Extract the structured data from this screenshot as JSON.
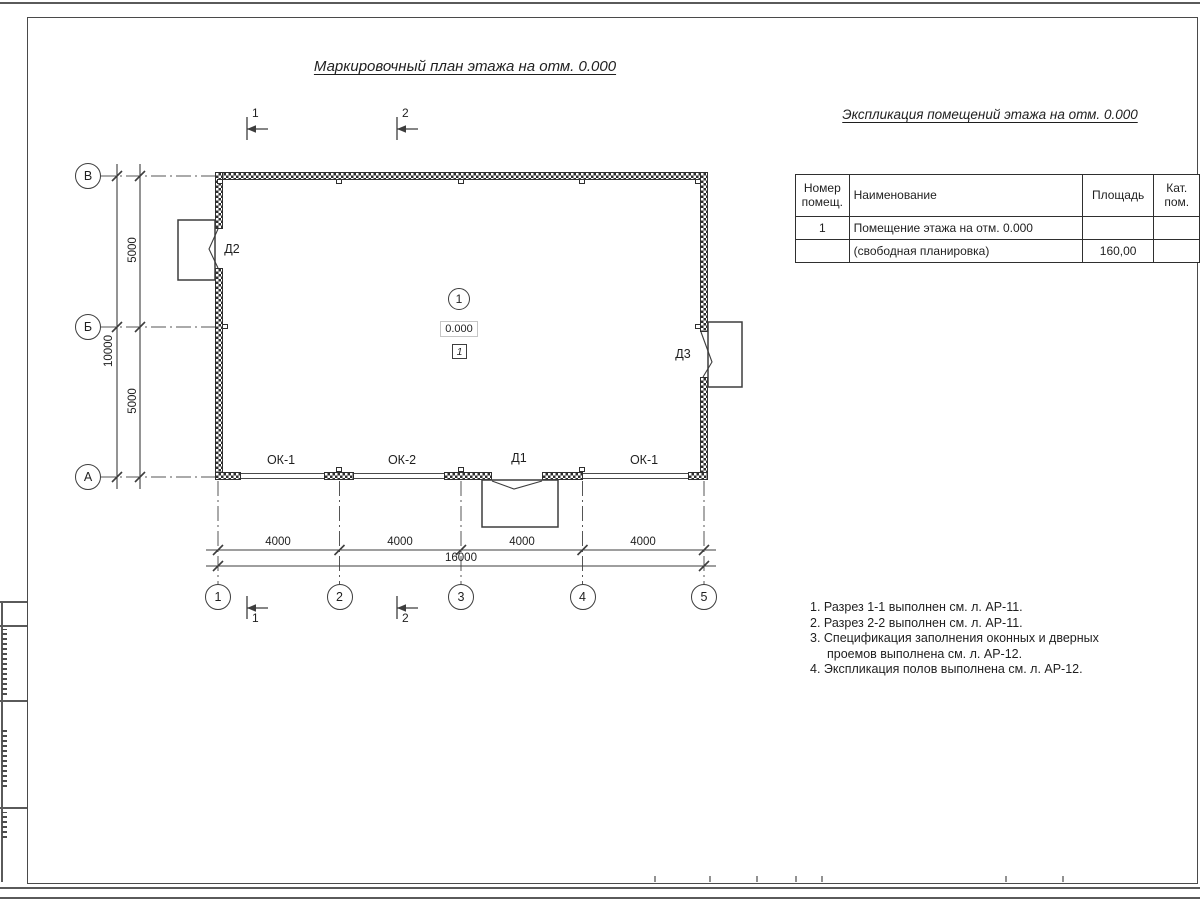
{
  "titles": {
    "plan": "Маркировочный план этажа на отм. 0.000",
    "table": "Экспликация помещений этажа на отм. 0.000"
  },
  "axes": {
    "vertical": [
      "В",
      "Б",
      "А"
    ],
    "horizontal": [
      "1",
      "2",
      "3",
      "4",
      "5"
    ]
  },
  "dimensions": {
    "bottom_segments": [
      "4000",
      "4000",
      "4000",
      "4000"
    ],
    "bottom_total": "16000",
    "left_upper": "5000",
    "left_lower": "5000",
    "left_total": "10000"
  },
  "sections": {
    "s1": "1",
    "s2": "2"
  },
  "room": {
    "number": "1",
    "elevation": "0.000",
    "floor_type": "1"
  },
  "labels": {
    "door_d1": "Д1",
    "door_d2": "Д2",
    "door_d3": "Д3",
    "window_ok1_left": "ОК-1",
    "window_ok2": "ОК-2",
    "window_ok1_right": "ОК-1"
  },
  "table": {
    "headers": {
      "num": "Номер помещ.",
      "name": "Наименование",
      "area": "Площадь",
      "cat": "Кат. пом."
    },
    "rows": [
      {
        "num": "1",
        "name": "Помещение этажа на отм. 0.000",
        "area": "",
        "cat": ""
      },
      {
        "num": "",
        "name": "(свободная планировка)",
        "area": "160,00",
        "cat": ""
      }
    ]
  },
  "notes": [
    "1. Разрез 1-1 выполнен см. л. АР-11.",
    "2. Разрез 2-2 выполнен см. л. АР-11.",
    "3. Спецификация заполнения оконных и дверных",
    "проемов выполнена см. л. АР-12.",
    "4. Экспликация полов выполнена см. л. АР-12."
  ]
}
